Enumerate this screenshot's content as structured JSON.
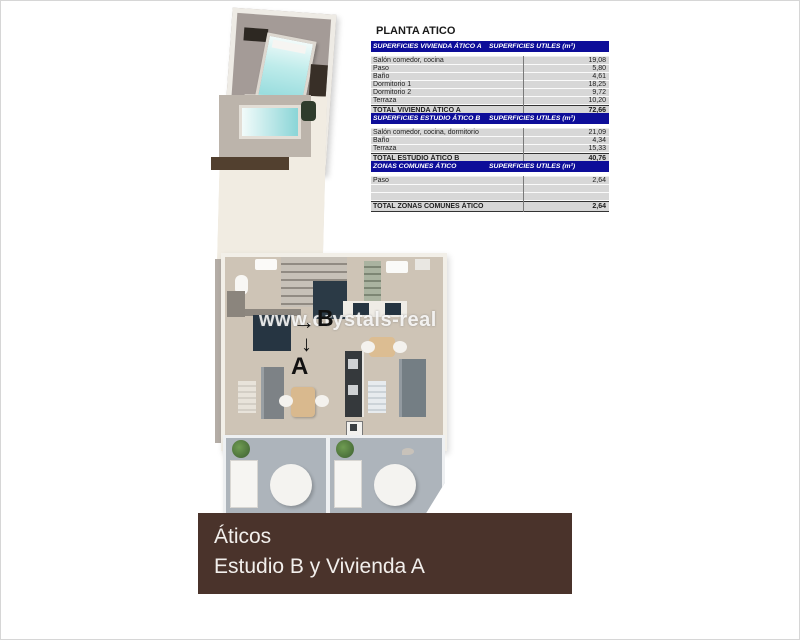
{
  "title": "PLANTA ATICO",
  "tables": [
    {
      "header_left": "SUPERFICIES VIVIENDA ÁTICO A",
      "header_right": "SUPERFICIES UTILES  (m²)",
      "rows": [
        {
          "label": "Salón comedor, cocina",
          "value": "19,08"
        },
        {
          "label": "Paso",
          "value": "5,80"
        },
        {
          "label": "Baño",
          "value": "4,61"
        },
        {
          "label": "Dormitorio 1",
          "value": "18,25"
        },
        {
          "label": "Dormitorio 2",
          "value": "9,72"
        },
        {
          "label": "Terraza",
          "value": "10,20"
        }
      ],
      "total_label": "TOTAL VIVIENDA ÁTICO A",
      "total_value": "72,66"
    },
    {
      "header_left": "SUPERFICIES ESTUDIO ÁTICO B",
      "header_right": "SUPERFICIES UTILES  (m²)",
      "rows": [
        {
          "label": "Salón comedor, cocina, dormitorio",
          "value": "21,09"
        },
        {
          "label": "Baño",
          "value": "4,34"
        },
        {
          "label": "Terraza",
          "value": "15,33"
        }
      ],
      "total_label": "TOTAL ESTUDIO ÁTICO B",
      "total_value": "40,76"
    },
    {
      "header_left": "ZONAS COMUNES ÁTICO",
      "header_right": "SUPERFICIES UTILES  (m²)",
      "rows": [
        {
          "label": "Paso",
          "value": "2,64"
        }
      ],
      "total_label": "TOTAL ZONAS COMUNES ÁTICO",
      "total_value": "2,64"
    }
  ],
  "plan": {
    "watermark": "www.crystals-real",
    "unit_a": "A",
    "unit_b": "B",
    "arrow_a": "↓",
    "arrow_b": "→"
  },
  "banner": {
    "line1": "Áticos",
    "line2": "Estudio B y Vivienda A"
  },
  "colors": {
    "table_header_bg": "#0d0d99",
    "banner_bg": "#4a332b",
    "sunbed_teal": "#8ad5d7",
    "interior_floor": "#cec4b6",
    "top_terrace_floor": "#a49b97",
    "bottom_terrace_floor": "#adb4bb",
    "furniture_navy": "#2b3a46",
    "deck_brown": "#52402f"
  }
}
